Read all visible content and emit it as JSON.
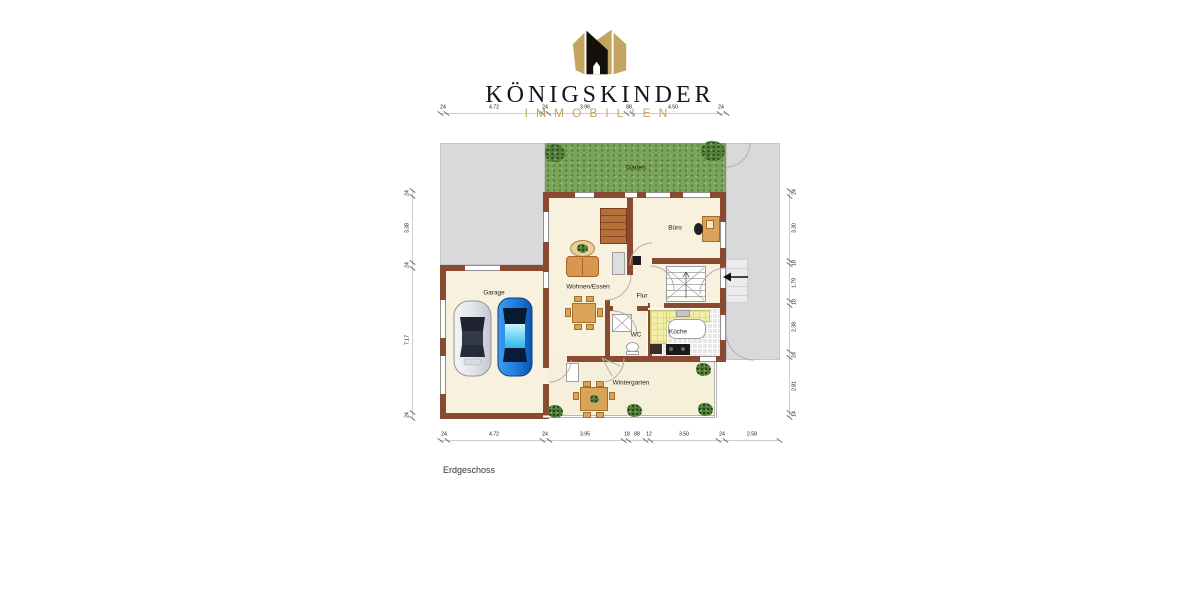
{
  "header": {
    "brand_title": "KÖNIGSKINDER",
    "brand_subtitle": "IMMOBILIEN"
  },
  "plan": {
    "floor_label": "Erdgeschoss",
    "room_labels": [
      {
        "id": "garten",
        "text": "Garten",
        "x": 636,
        "y": 168
      },
      {
        "id": "buero",
        "text": "Büro",
        "x": 675,
        "y": 228
      },
      {
        "id": "wohnen-essen",
        "text": "Wohnen/Essen",
        "x": 588,
        "y": 287
      },
      {
        "id": "flur",
        "text": "Flur",
        "x": 642,
        "y": 296
      },
      {
        "id": "wc",
        "text": "WC",
        "x": 636,
        "y": 335
      },
      {
        "id": "kueche",
        "text": "Küche",
        "x": 678,
        "y": 332
      },
      {
        "id": "garage",
        "text": "Garage",
        "x": 494,
        "y": 293
      },
      {
        "id": "wintergarten",
        "text": "Wintergarten",
        "x": 631,
        "y": 383
      }
    ]
  },
  "dimensions": [
    {
      "id": "top",
      "dir": "h",
      "x": 440,
      "y": 113,
      "len": 286,
      "labels": [
        {
          "t": "24",
          "p": 443
        },
        {
          "t": "4.72",
          "p": 494
        },
        {
          "t": "24",
          "p": 545
        },
        {
          "t": "3.96",
          "p": 585
        },
        {
          "t": "88",
          "p": 629
        },
        {
          "t": "4.50",
          "p": 673
        },
        {
          "t": "24",
          "p": 721
        }
      ],
      "ticks": [
        440,
        446,
        542,
        548,
        626,
        632,
        719,
        726
      ]
    },
    {
      "id": "bottom",
      "dir": "h",
      "x": 440,
      "y": 440,
      "len": 339,
      "labels": [
        {
          "t": "24",
          "p": 444
        },
        {
          "t": "4.72",
          "p": 494
        },
        {
          "t": "24",
          "p": 545
        },
        {
          "t": "3.95",
          "p": 585
        },
        {
          "t": "18",
          "p": 627
        },
        {
          "t": "88",
          "p": 637
        },
        {
          "t": "12",
          "p": 649
        },
        {
          "t": "3.50",
          "p": 684
        },
        {
          "t": "24",
          "p": 722
        },
        {
          "t": "2.58",
          "p": 752
        }
      ],
      "ticks": [
        440,
        447,
        542,
        549,
        623,
        628,
        645,
        650,
        718,
        725,
        779
      ]
    },
    {
      "id": "left",
      "dir": "v",
      "x": 412,
      "y": 190,
      "len": 228,
      "side": -5,
      "labels": [
        {
          "t": "24",
          "p": 193
        },
        {
          "t": "3.38",
          "p": 228
        },
        {
          "t": "24",
          "p": 265
        },
        {
          "t": "7.17",
          "p": 340
        },
        {
          "t": "24",
          "p": 415
        }
      ],
      "ticks": [
        190,
        196,
        262,
        268,
        412,
        418
      ]
    },
    {
      "id": "right",
      "dir": "v",
      "x": 789,
      "y": 190,
      "len": 227,
      "side": 5,
      "labels": [
        {
          "t": "24",
          "p": 192
        },
        {
          "t": "3.30",
          "p": 228
        },
        {
          "t": "18",
          "p": 263
        },
        {
          "t": "1.79",
          "p": 283
        },
        {
          "t": "18",
          "p": 302
        },
        {
          "t": "2.38",
          "p": 327
        },
        {
          "t": "24",
          "p": 355
        },
        {
          "t": "2.81",
          "p": 386
        },
        {
          "t": "14",
          "p": 414
        }
      ],
      "ticks": [
        190,
        196,
        260,
        264,
        300,
        305,
        351,
        357,
        412,
        417
      ]
    }
  ],
  "colors": {
    "wall": "#8a4a31",
    "floor": "#f8f1de",
    "garden": "#7aa45b",
    "paving": "#d9d9d9",
    "kitchen_counter": "#f3eea6",
    "accent_gold": "#c3a461",
    "brand_black": "#15151d",
    "car_silver": "#dfe2e8",
    "car_blue": "#1f7fe0"
  }
}
